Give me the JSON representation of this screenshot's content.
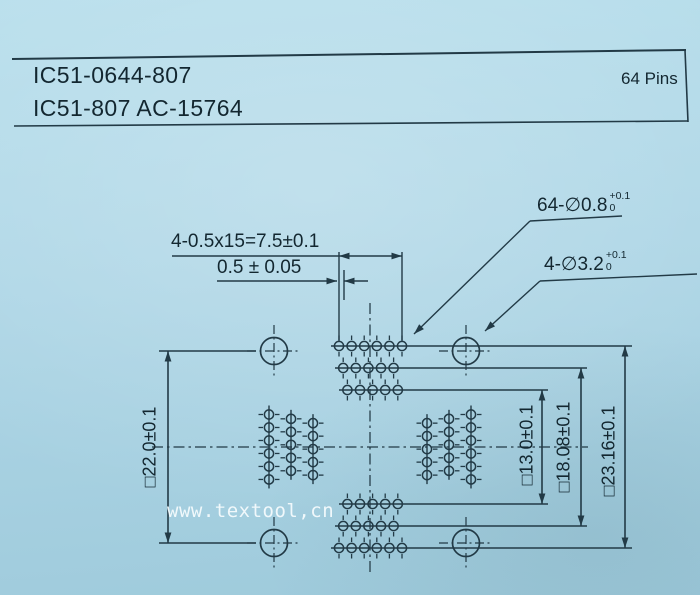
{
  "header": {
    "line1": "IC51-0644-807",
    "line2": "IC51-807 AC-15764",
    "pins_label": "64 Pins"
  },
  "dimensions": {
    "pitch": "4-0.5x15=7.5±0.1",
    "stagger_offset": "0.5 ± 0.05",
    "pin_hole": {
      "label": "64-∅0.8",
      "tol_plus": "+0.1",
      "tol_minus": "0"
    },
    "guide_hole": {
      "label": "4-∅3.2",
      "tol_plus": "+0.1",
      "tol_minus": "0"
    },
    "left_square": "□22.0±0.1",
    "inner_square": "□13.0±0.1",
    "middle_square": "□18.08±0.1",
    "outer_square": "□23.16±0.1"
  },
  "watermark": "www.textool,cn",
  "colors": {
    "paper": "#abd4e4",
    "ink": "#223a46",
    "text": "#132730",
    "watermark": "#f5fbfd"
  }
}
